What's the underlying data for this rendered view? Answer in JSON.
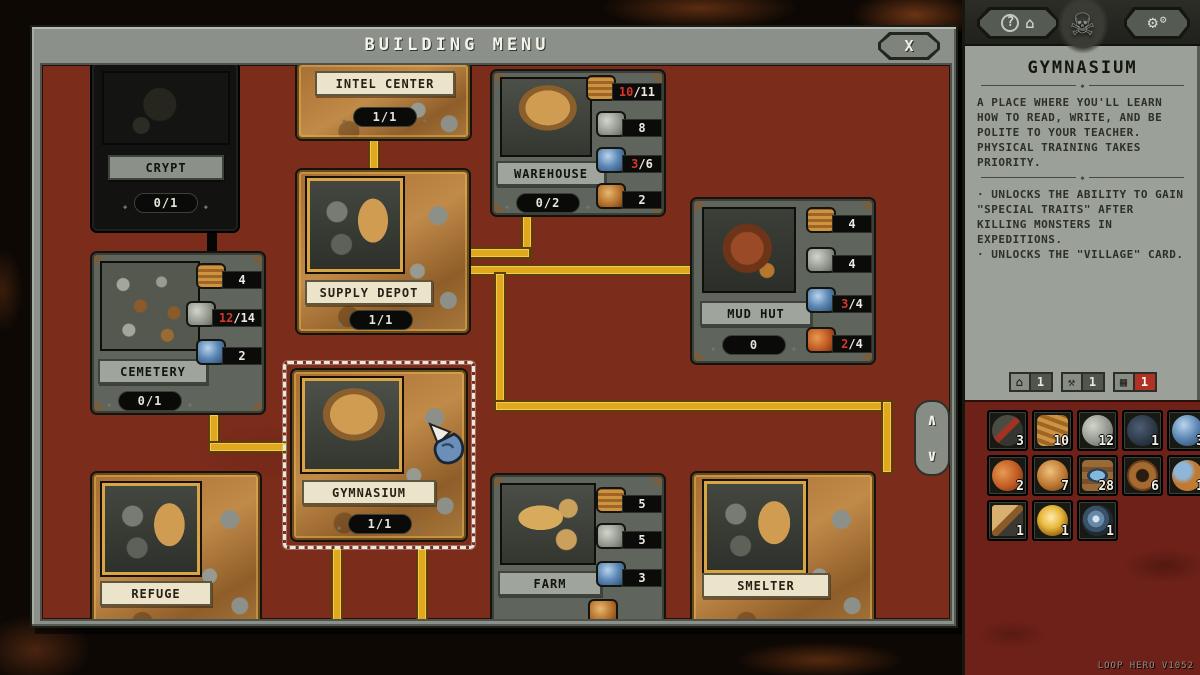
{
  "window": {
    "title": "BUILDING MENU",
    "close_label": "X",
    "version": "LOOP HERO V1052"
  },
  "icons": {
    "scroll_up": "∧",
    "scroll_down": "∨",
    "help": "?",
    "building": "⌂",
    "gear_big": "⚙",
    "gear_small": "⚙",
    "skull": "☠",
    "badge_home": "⌂",
    "badge_tools": "⚒",
    "badge_card": "▦",
    "ornament": "◆"
  },
  "map": {
    "cards": [
      {
        "id": "crypt",
        "label": "CRYPT",
        "count": "0/1"
      },
      {
        "id": "intel-center",
        "label": "INTEL CENTER",
        "count": "1/1"
      },
      {
        "id": "warehouse",
        "label": "WAREHOUSE",
        "count": "0/2",
        "resources": [
          {
            "icon": "wood-planks",
            "red": "10",
            "white": "/11"
          },
          {
            "icon": "stone",
            "red": "",
            "white": "8"
          },
          {
            "icon": "metal-orb",
            "red": "3",
            "white": "/6"
          },
          {
            "icon": "copper-sphere",
            "red": "",
            "white": "2"
          }
        ]
      },
      {
        "id": "cemetery",
        "label": "CEMETERY",
        "count": "0/1",
        "resources": [
          {
            "icon": "wood-planks",
            "red": "",
            "white": "4"
          },
          {
            "icon": "stone",
            "red": "12",
            "white": "/14"
          },
          {
            "icon": "metal-orb",
            "red": "",
            "white": "2"
          }
        ]
      },
      {
        "id": "supply-depot",
        "label": "SUPPLY DEPOT",
        "count": "1/1"
      },
      {
        "id": "gymnasium",
        "label": "GYMNASIUM",
        "count": "1/1"
      },
      {
        "id": "mud-hut",
        "label": "MUD HUT",
        "count": "0",
        "resources": [
          {
            "icon": "wood-planks",
            "red": "",
            "white": "4"
          },
          {
            "icon": "stone",
            "red": "",
            "white": "4"
          },
          {
            "icon": "metal-orb",
            "red": "3",
            "white": "/4"
          },
          {
            "icon": "food",
            "red": "2",
            "white": "/4"
          }
        ]
      },
      {
        "id": "refuge",
        "label": "REFUGE"
      },
      {
        "id": "farm",
        "label": "FARM",
        "resources": [
          {
            "icon": "wood-planks",
            "red": "",
            "white": "5"
          },
          {
            "icon": "stone",
            "red": "",
            "white": "5"
          },
          {
            "icon": "metal-orb",
            "red": "",
            "white": "3"
          }
        ]
      },
      {
        "id": "smelter",
        "label": "SMELTER"
      }
    ]
  },
  "sidebar": {
    "detail": {
      "title": "GYMNASIUM",
      "description": "A PLACE WHERE YOU'LL LEARN HOW TO READ, WRITE, AND BE POLITE TO YOUR TEACHER. PHYSICAL TRAINING TAKES PRIORITY.",
      "bullet1": "· UNLOCKS THE ABILITY TO GAIN \"SPECIAL TRAITS\" AFTER KILLING MONSTERS IN EXPEDITIONS.",
      "bullet2": "· UNLOCKS THE \"VILLAGE\" CARD."
    },
    "badges": [
      {
        "value": "1"
      },
      {
        "value": "1"
      },
      {
        "value": "1"
      }
    ],
    "resources": [
      {
        "icon": "scrap",
        "value": "3"
      },
      {
        "icon": "wood-planks",
        "value": "10"
      },
      {
        "icon": "stone",
        "value": "12"
      },
      {
        "icon": "weapon-parts",
        "value": "1"
      },
      {
        "icon": "metal-orb",
        "value": "3"
      },
      {
        "icon": "food-supply",
        "value": "2"
      },
      {
        "icon": "amber-sphere",
        "value": "7"
      },
      {
        "icon": "memory-fragment",
        "value": "28"
      },
      {
        "icon": "rope",
        "value": "6"
      },
      {
        "icon": "astral-orb",
        "value": "1"
      },
      {
        "icon": "shingle",
        "value": "1"
      },
      {
        "icon": "golden-orb",
        "value": "1"
      },
      {
        "icon": "ancient-shell",
        "value": "1"
      }
    ]
  }
}
